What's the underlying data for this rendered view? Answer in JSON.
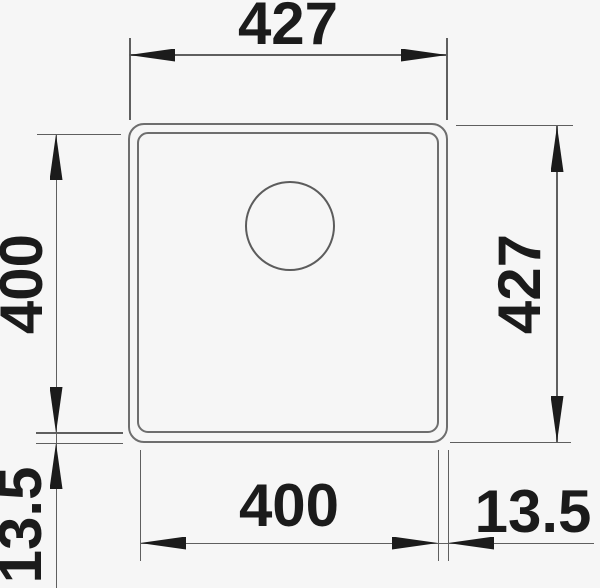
{
  "drawing": {
    "type": "technical-dimension-diagram",
    "subject": "square sink bowl, top view with drain hole",
    "colors": {
      "background": "#f6f6f6",
      "outline": "#6e6e6e",
      "dimension_lines": "#5f5f5f",
      "text_and_arrows": "#1b1b1b"
    },
    "dimensions": {
      "top_outer_width": "427",
      "right_outer_height": "427",
      "left_inner_height": "400",
      "bottom_inner_width": "400",
      "bottom_left_edge_offset": "13.5",
      "bottom_right_edge_offset": "13.5"
    }
  }
}
